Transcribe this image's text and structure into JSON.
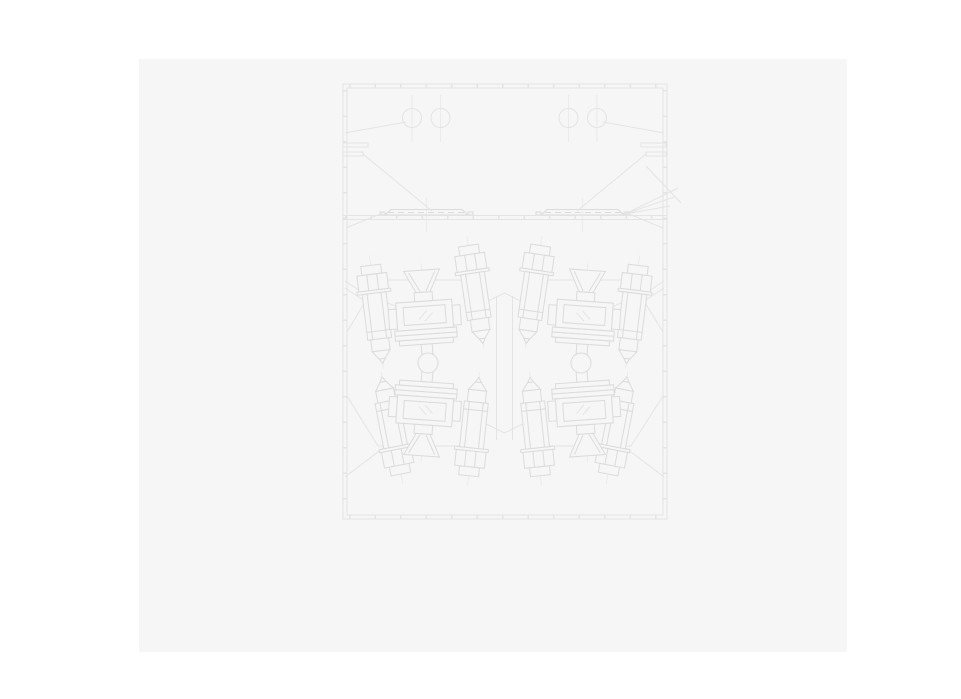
{
  "colors": {
    "page": "#ffffff",
    "panel": "#f6f6f6",
    "line": "#e4e4e4",
    "strong": "#dbdbdb",
    "center": "#e9e9e9",
    "hatch": "#eaeaea",
    "fill": "#f6f6f6"
  },
  "drawing": {
    "kind": "technical-section-drawing",
    "visible_text": "",
    "features": {
      "top_cover_holes": 4,
      "cover_plates": 2,
      "plug_bolt_units": 8,
      "sight_window_cartridges": 4,
      "shaft_circles": 2
    }
  }
}
